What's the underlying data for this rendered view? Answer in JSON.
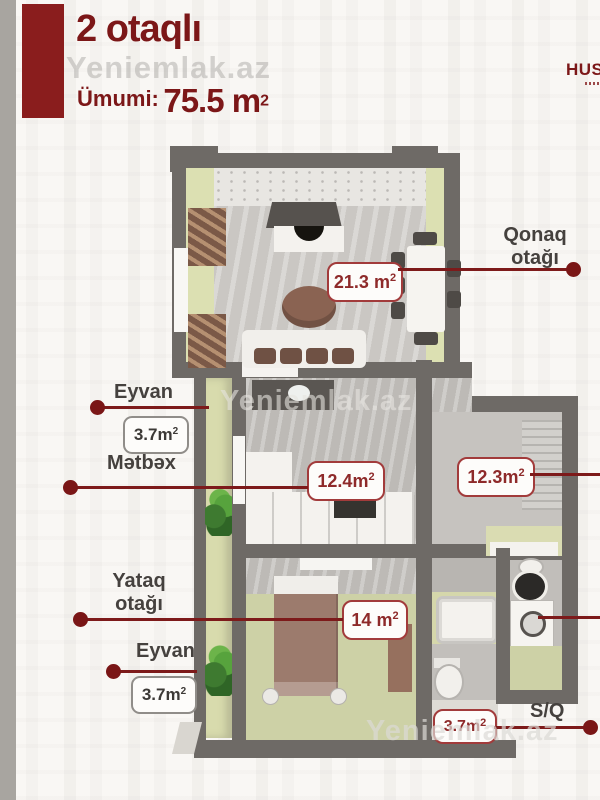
{
  "watermark": {
    "text": "Yeniemlak.az"
  },
  "header": {
    "title": "2 otaqlı",
    "total_label": "Ümumi:",
    "total_value": "75.5 m",
    "total_sup": "2",
    "logo": "HUS"
  },
  "rooms": {
    "living": {
      "label_line1": "Qonaq",
      "label_line2": "otağı",
      "area": "21.3 m",
      "area_sup": "2"
    },
    "balcony_top": {
      "label": "Eyvan",
      "area": "3.7m",
      "area_sup": "2"
    },
    "kitchen": {
      "label": "Mətbəx",
      "area": "12.4m",
      "area_sup": "2"
    },
    "hall": {
      "area": "12.3m",
      "area_sup": "2"
    },
    "bedroom": {
      "label_line1": "Yataq",
      "label_line2": "otağı",
      "area": "14 m",
      "area_sup": "2"
    },
    "balcony_bottom": {
      "label": "Eyvan",
      "area": "3.7m",
      "area_sup": "2"
    },
    "bathroom": {
      "label": "S/Q",
      "area": "3.7m",
      "area_sup": "2"
    }
  },
  "colors": {
    "accent_red": "#8a1d1d",
    "wall_gray": "#6e6a66",
    "floor_green": "#cdd1a6",
    "label_text": "#45413e"
  }
}
